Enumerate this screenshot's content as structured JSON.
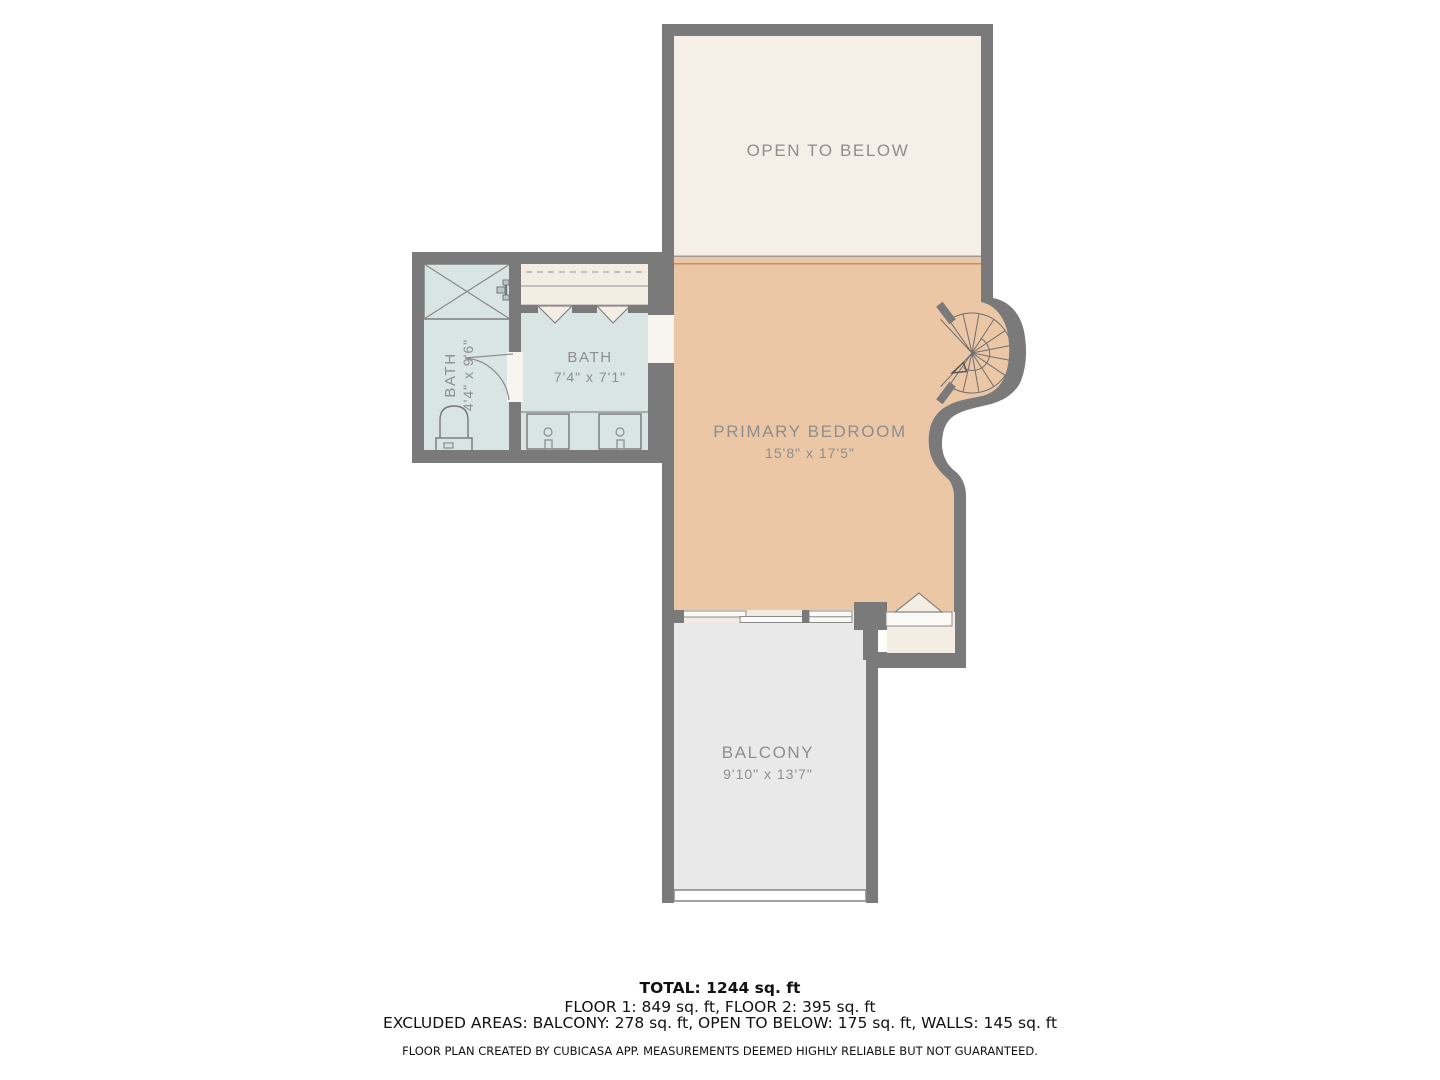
{
  "plan": {
    "rooms": {
      "open_to_below": {
        "label": "OPEN TO BELOW"
      },
      "bath_small": {
        "label": "BATH",
        "dims": "4'4\" x 9'6\""
      },
      "bath_main": {
        "label": "BATH",
        "dims": "7'4\" x 7'1\""
      },
      "primary_bedroom": {
        "label": "PRIMARY BEDROOM",
        "dims": "15'8\" x 17'5\""
      },
      "balcony": {
        "label": "BALCONY",
        "dims": "9'10\" x 13'7\""
      }
    },
    "colors": {
      "wall": "#7a7a7a",
      "open_to_below_fill": "#f6efe8",
      "bedroom_fill": "#ebc7a6",
      "bath_fill": "#d8e5e3",
      "balcony_fill": "#e9e9e9",
      "closet_fill": "#f4ede4",
      "label_text": "#8e8e8e",
      "divider_accent": "#c08f66"
    }
  },
  "summary": {
    "total": "TOTAL: 1244 sq. ft",
    "floors": "FLOOR 1: 849 sq. ft, FLOOR 2: 395 sq. ft",
    "excluded": "EXCLUDED AREAS: BALCONY: 278 sq. ft, OPEN TO BELOW: 175 sq. ft, WALLS: 145 sq. ft",
    "disclaimer": "FLOOR PLAN CREATED BY CUBICASA APP. MEASUREMENTS DEEMED HIGHLY RELIABLE BUT NOT GUARANTEED."
  }
}
